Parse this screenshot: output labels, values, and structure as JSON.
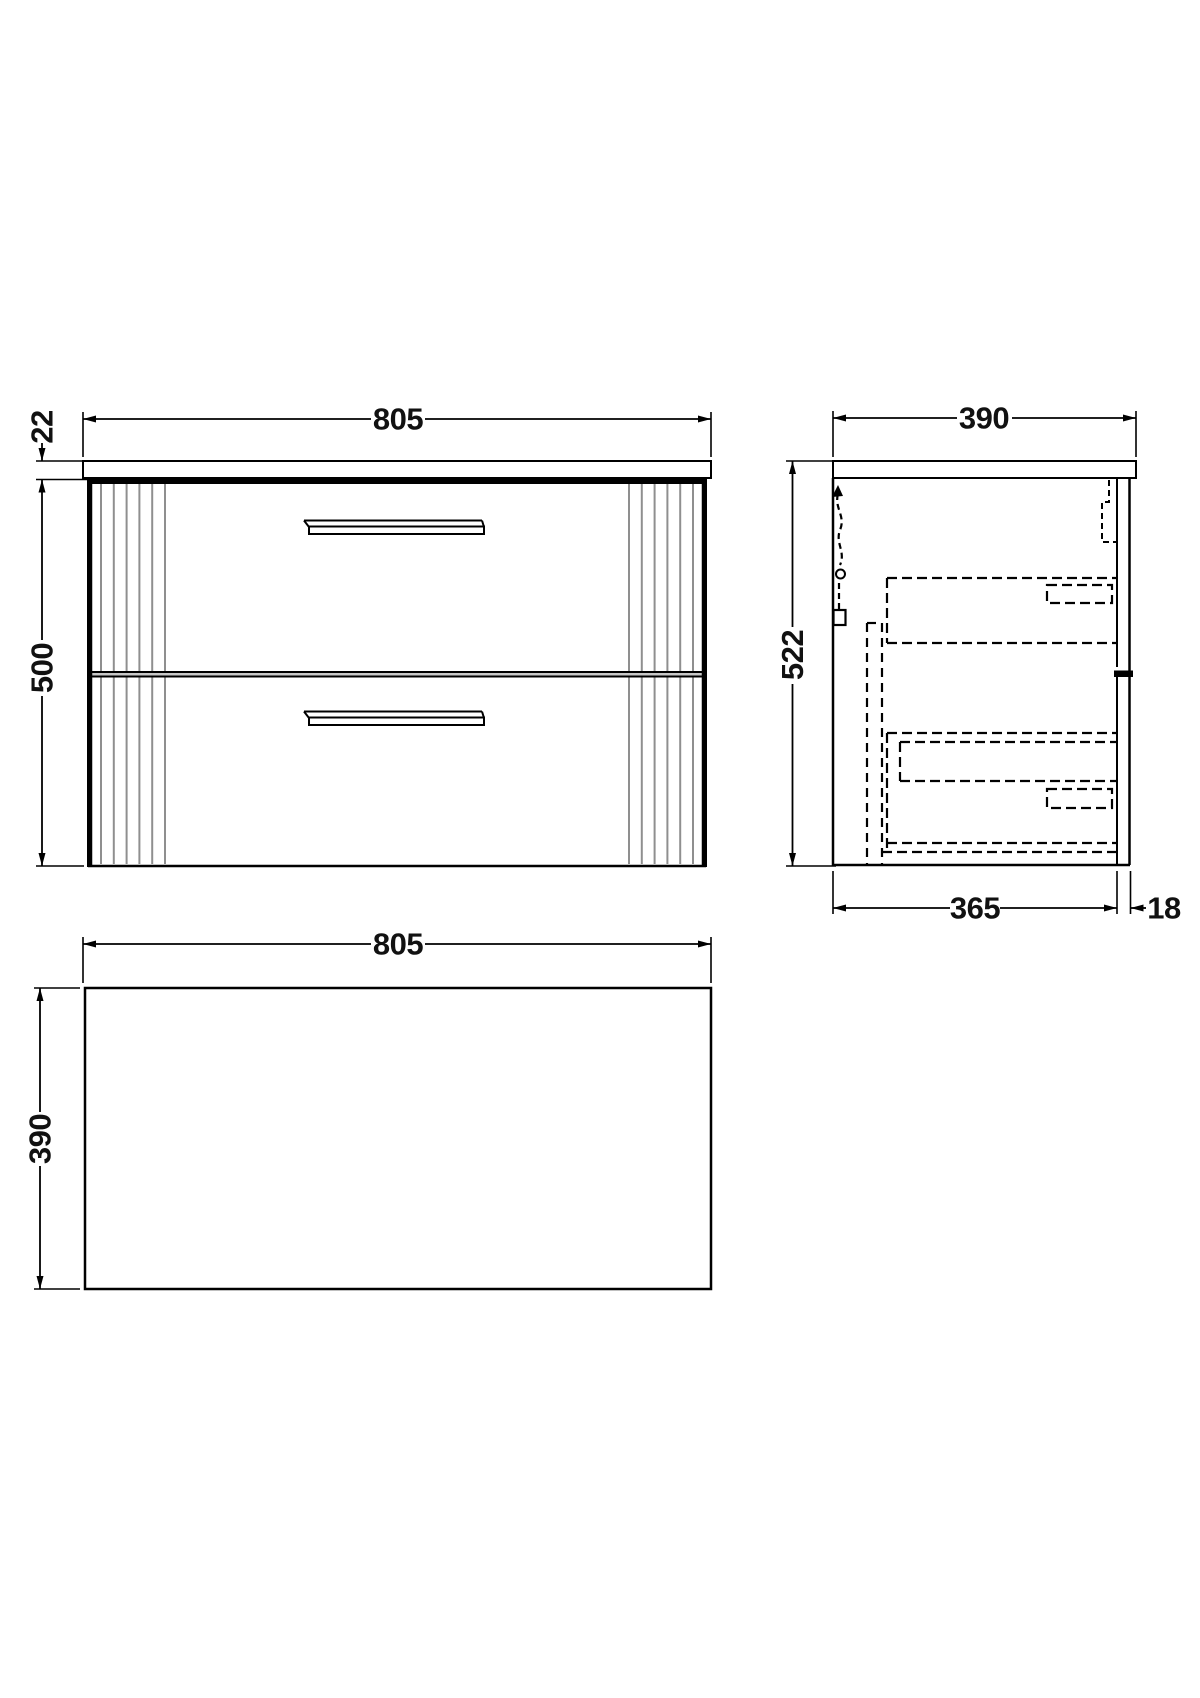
{
  "drawing": {
    "background": "#ffffff",
    "line_color": "#000000",
    "flute_color": "#8f8f8f",
    "front_view": {
      "width": "805",
      "worktop_thickness": "22",
      "cabinet_height": "500"
    },
    "side_view": {
      "depth": "390",
      "overall_height": "522",
      "carcass_depth": "365",
      "front_thickness": "18"
    },
    "plan_view": {
      "width": "805",
      "depth": "390"
    }
  }
}
